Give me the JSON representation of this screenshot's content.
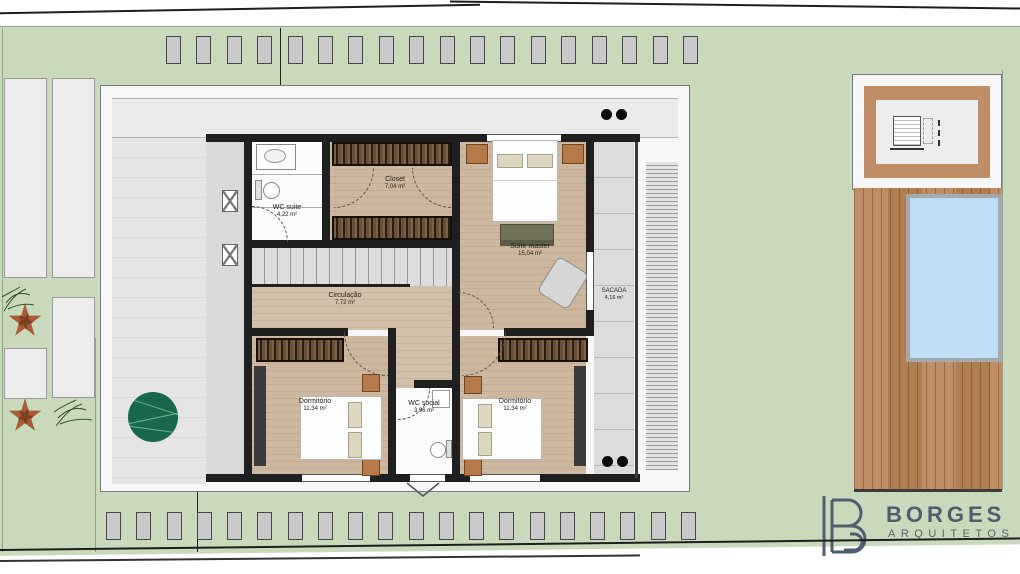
{
  "brand": {
    "name": "BORGES",
    "subtitle": "ARQUITETOS",
    "color": "#4d5f6e"
  },
  "floor_plan": {
    "rooms": {
      "wc_suite": {
        "label": "WC suite",
        "area": "4,22 m²"
      },
      "closet": {
        "label": "Closet",
        "area": "7,04 m²"
      },
      "suite_master": {
        "label": "Suíte master",
        "area": "15,04 m²"
      },
      "circulacao": {
        "label": "Circulação",
        "area": "7,72 m²"
      },
      "sacada": {
        "label": "SACADA",
        "area": "4,16 m²"
      },
      "dormitorio_1": {
        "label": "Dormitório",
        "area": "11,34 m²"
      },
      "wc_social": {
        "label": "WC social",
        "area": "3,96 m²"
      },
      "dormitorio_2": {
        "label": "Dormitório",
        "area": "11,34 m²"
      }
    },
    "pergola": {
      "top_blocks": 18,
      "bottom_blocks": 20
    }
  },
  "site": {
    "colors": {
      "lawn": "#c9dabc",
      "wood_floor": "#c9b39b",
      "deck": "#bd8b63",
      "pool_water": "#bfdef5",
      "interior_wall": "#1f1f1f"
    }
  }
}
